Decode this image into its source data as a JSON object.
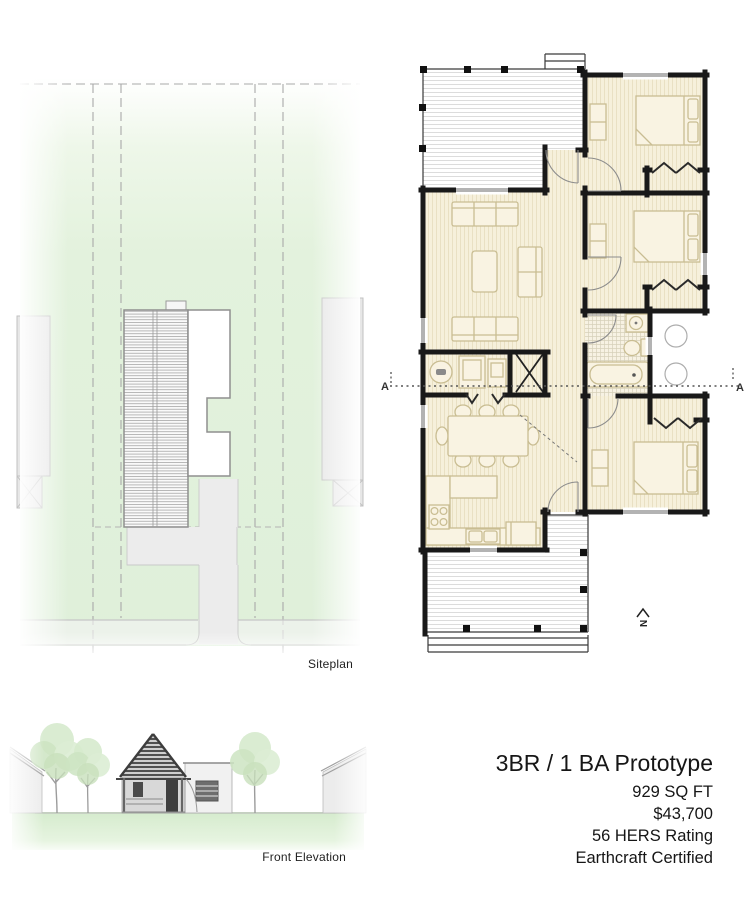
{
  "sheet": {
    "background": "#ffffff"
  },
  "siteplan": {
    "label": "Siteplan",
    "colors": {
      "lawn": "#e2f1dc",
      "hardscape": "#ebebeb",
      "roof_hatch": "#ababab",
      "outline": "#8f8f8f"
    }
  },
  "floorplan": {
    "section_label_left": "A",
    "section_label_right": "A",
    "north_label": "N",
    "colors": {
      "wall": "#191919",
      "floor": "#f6f0db",
      "furniture_line": "#c9bd92",
      "window": "#b3b3b3"
    }
  },
  "elevation": {
    "label": "Front Elevation",
    "colors": {
      "lawn": "#d9eed2",
      "tree": "#d3e8ca",
      "siding": "#e8e8e8",
      "accent_dark": "#4a4a4a"
    }
  },
  "info": {
    "title": "3BR / 1 BA Prototype",
    "details": [
      "929 SQ FT",
      "$43,700",
      "56 HERS Rating",
      "Earthcraft Certified"
    ]
  }
}
